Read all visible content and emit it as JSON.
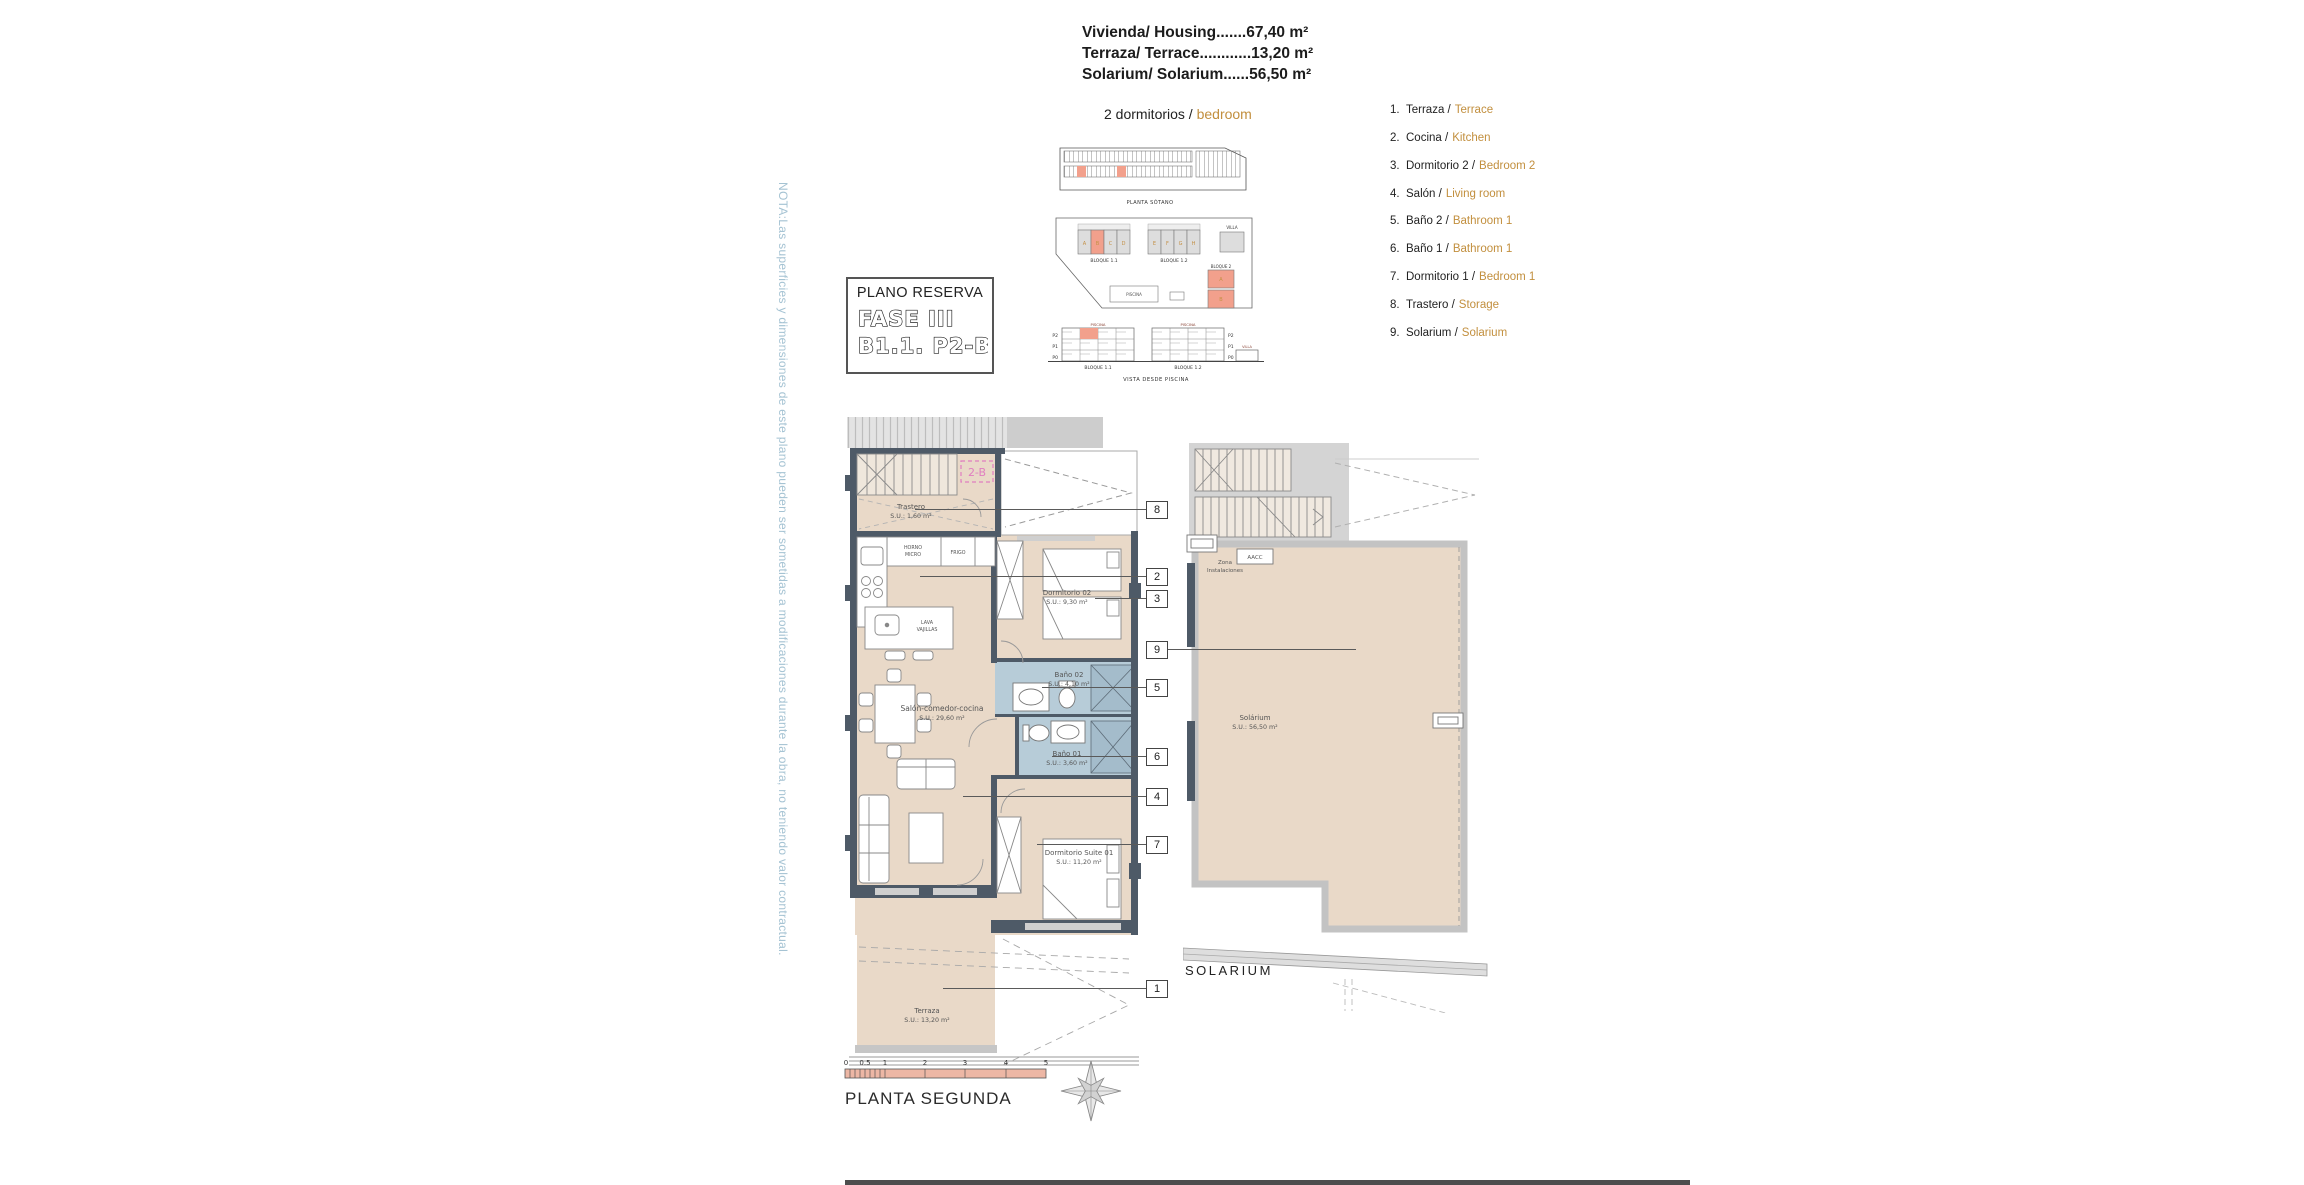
{
  "colors": {
    "accent": "#c28f3e",
    "note_blue": "#a5c3d3",
    "floor": "#e9d9c8",
    "bath": "#b7ccd8",
    "wall": "#4e5a67",
    "highlight": "#f2a08c",
    "tag_pink": "#e07ec0"
  },
  "summary": [
    "Vivienda/ Housing.......67,40 m²",
    "Terraza/ Terrace............13,20 m²",
    "Solarium/ Solarium......56,50 m²"
  ],
  "bedrooms": {
    "es": "2 dormitorios /",
    "en": "bedroom"
  },
  "note": "NOTA:Las superficies y dimensiones de este plano pueden ser sometidas a modificaciones durante la obra, no teniendo valor contractual.",
  "reserva": {
    "title": "PLANO RESERVA",
    "phase": "FASE III",
    "unit": "B1.1. P2-B"
  },
  "legend": [
    {
      "num": "1.",
      "es": "Terraza /",
      "en": "Terrace"
    },
    {
      "num": "2.",
      "es": "Cocina /",
      "en": "Kitchen"
    },
    {
      "num": "3.",
      "es": "Dormitorio 2 /",
      "en": "Bedroom 2"
    },
    {
      "num": "4.",
      "es": "Salón /",
      "en": "Living room"
    },
    {
      "num": "5.",
      "es": "Baño 2 /",
      "en": "Bathroom 1"
    },
    {
      "num": "6.",
      "es": "Baño 1 /",
      "en": "Bathroom 1"
    },
    {
      "num": "7.",
      "es": "Dormitorio 1 /",
      "en": "Bedroom 1"
    },
    {
      "num": "8.",
      "es": "Trastero /",
      "en": "Storage"
    },
    {
      "num": "9.",
      "es": "Solarium /",
      "en": "Solarium"
    }
  ],
  "site": {
    "basement_caption": "PLANTA SÓTANO",
    "view_caption": "VISTA DESDE PISCINA",
    "block11": "BLOQUE 1.1",
    "block12": "BLOQUE 1.2",
    "block2": "BLOQUE 2",
    "villa": "VILLA",
    "piscina": "PISCINA",
    "floors": [
      "P2",
      "P1",
      "P0"
    ],
    "units11": [
      "A",
      "B",
      "C",
      "D"
    ],
    "units12": [
      "E",
      "F",
      "G",
      "H"
    ],
    "units2": [
      "A",
      "B"
    ]
  },
  "unit_tag": "2-B",
  "rooms": {
    "trastero": {
      "name": "Trastero",
      "area": "S.U.: 1,60 m²"
    },
    "dorm2": {
      "name": "Dormitorio 02",
      "area": "S.U.: 9,30 m²"
    },
    "bano2": {
      "name": "Baño 02",
      "area": "S.U.: 4,10 m²"
    },
    "bano1": {
      "name": "Baño 01",
      "area": "S.U.: 3,60 m²"
    },
    "salon": {
      "name": "Salón-comedor-cocina",
      "area": "S.U.: 29,60 m²"
    },
    "suite": {
      "name": "Dormitorio Suite 01",
      "area": "S.U.: 11,20 m²"
    },
    "terraza": {
      "name": "Terraza",
      "area": "S.U.: 13,20 m²"
    }
  },
  "kitchen": {
    "horno1": "HORNO",
    "horno2": "MICRO",
    "frigo": "FRIGO",
    "lava1": "LAVA",
    "lava2": "VAJILLAS"
  },
  "solar": {
    "zona1": "Zona",
    "zona2": "Instalaciones",
    "aacc": "AACC",
    "name": "Solárium",
    "area": "S.U.: 56,50 m²",
    "caption": "SOLARIUM"
  },
  "callouts": [
    "8",
    "2",
    "3",
    "9",
    "5",
    "6",
    "4",
    "7",
    "1"
  ],
  "scale": {
    "ticks": [
      "0",
      "0.5",
      "1",
      "2",
      "3",
      "4",
      "5"
    ],
    "caption": "PLANTA SEGUNDA"
  }
}
